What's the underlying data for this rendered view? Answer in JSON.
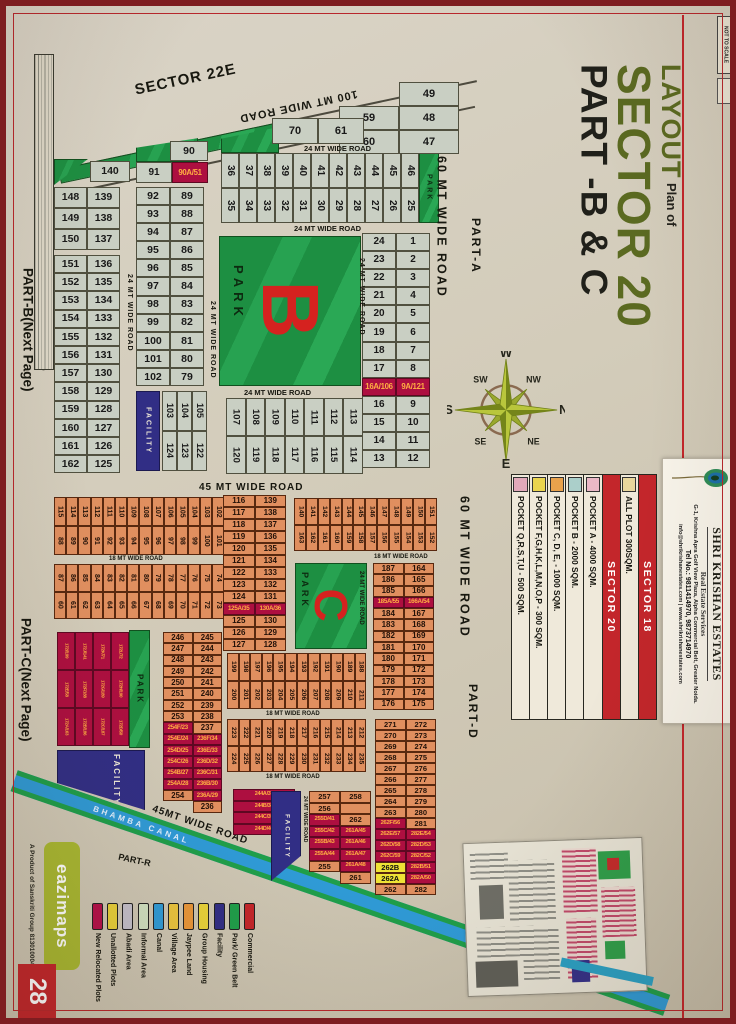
{
  "page": {
    "number": "28",
    "publisher": "eazimaps",
    "publisher_tm": "TM",
    "product": "A Product of Sanskriti Group 8130100046, 9910582177",
    "not_to_scale": "NOT TO SCALE"
  },
  "title": {
    "line1": "LAYOUT",
    "line2": "Plan of",
    "line3": "SECTOR 20",
    "line4": "PART -B & C"
  },
  "sections": {
    "sector22e": "SECTOR 22E",
    "part_a": "PART-A",
    "part_b": "PART-B(Next Page)",
    "part_c": "PART-C(Next Page)",
    "part_d": "PART-D",
    "part_r": "PART-R"
  },
  "roads": {
    "r100": "100 MT WIDE ROAD",
    "r60": "60 MT WIDE ROAD",
    "r45": "45 MT WIDE ROAD",
    "r45b": "45MT WIDE ROAD",
    "r24": "24 MT WIDE ROAD",
    "r18": "18 MT WIDE ROAD",
    "canal": "BHAMBA CANAL"
  },
  "labels": {
    "park": "PARK",
    "facility": "FACILITY",
    "park_b": "B",
    "park_c": "C"
  },
  "compass": {
    "n": "N",
    "s": "S",
    "e": "E",
    "w": "W",
    "ne": "NE",
    "nw": "NW",
    "se": "SE",
    "sw": "SW"
  },
  "info_table": {
    "rows": [
      {
        "label": "SECTOR 18",
        "cls": "hdr"
      },
      {
        "label": "ALL PLOT  300SQM.",
        "color": "#e9d79c"
      },
      {
        "label": "SECTOR 20",
        "cls": "hdr"
      },
      {
        "label": "POCKET A   -  4000 SQM.",
        "color": "#eab8c6"
      },
      {
        "label": "POCKET B   -  2000 SQM.",
        "color": "#abcfca"
      },
      {
        "label": "POCKET C, D, E, - 1000 SQM.",
        "color": "#e9a24c"
      },
      {
        "label": "POCKET  F,G,H,K,L,M,N,O,P - 300 SQM.",
        "color": "#ead44e"
      },
      {
        "label": "POCKET Q,R,S,T,U   -   500 SQM.",
        "color": "#e2a9ba"
      }
    ]
  },
  "card": {
    "name": "SHRI KRISHAN ESTATES",
    "tagline": "Real Estate Services",
    "address": "G-1, Krishna Apra Golf View Plaza, Alpha Commercial Belt, Greater Noida.",
    "phone": "Tel No.: 9811414970, 9873714970",
    "email": "info@shrikrishanestates.com | www.shrikrishanestates.com"
  },
  "legend": {
    "items": [
      {
        "label": "New Relocated Plots",
        "color": "#b5104a"
      },
      {
        "label": "Unallotted Plots",
        "color": "#e8cf3a"
      },
      {
        "label": "Abadi Area",
        "color": "#c3bfca"
      },
      {
        "label": "Informal Area",
        "color": "#cfdfc0"
      },
      {
        "label": "Canal",
        "color": "#2f9ad6"
      },
      {
        "label": "Village Area",
        "color": "#eac43e"
      },
      {
        "label": "Jaypee Land",
        "color": "#e8963a"
      },
      {
        "label": "Group Housing",
        "color": "#e8d23a"
      },
      {
        "label": "Facility",
        "color": "#312e85"
      },
      {
        "label": "Park/ Green Belt",
        "color": "#1f9e4a"
      },
      {
        "label": "Commercial",
        "color": "#c3262b"
      }
    ]
  },
  "plots": {
    "stair49": [
      [
        "",
        "49"
      ],
      [
        "59",
        "48"
      ],
      [
        "60",
        "47"
      ]
    ],
    "pair7061": [
      [
        "70",
        "61"
      ]
    ],
    "grid36": [
      [
        "36",
        "35"
      ],
      [
        "37",
        "34"
      ],
      [
        "38",
        "33"
      ],
      [
        "39",
        "32"
      ],
      [
        "40",
        "31"
      ],
      [
        "41",
        "30"
      ],
      [
        "42",
        "29"
      ],
      [
        "43",
        "28"
      ],
      [
        "44",
        "27"
      ],
      [
        "45",
        "26"
      ],
      [
        "46",
        "25"
      ]
    ],
    "cell90": "90",
    "cell140": "140",
    "pair91": [
      [
        "91",
        "90A/51"
      ]
    ],
    "colA": [
      [
        "148",
        "139"
      ],
      [
        "149",
        "138"
      ],
      [
        "150",
        "137"
      ]
    ],
    "colB": [
      [
        "151",
        "136"
      ],
      [
        "152",
        "135"
      ],
      [
        "153",
        "134"
      ],
      [
        "154",
        "133"
      ],
      [
        "155",
        "132"
      ],
      [
        "156",
        "131"
      ],
      [
        "157",
        "130"
      ],
      [
        "158",
        "129"
      ],
      [
        "159",
        "128"
      ],
      [
        "160",
        "127"
      ],
      [
        "161",
        "126"
      ],
      [
        "162",
        "125"
      ]
    ],
    "colC": [
      [
        "92",
        "89"
      ],
      [
        "93",
        "88"
      ],
      [
        "94",
        "87"
      ],
      [
        "95",
        "86"
      ],
      [
        "96",
        "85"
      ],
      [
        "97",
        "84"
      ],
      [
        "98",
        "83"
      ],
      [
        "99",
        "82"
      ],
      [
        "100",
        "81"
      ],
      [
        "101",
        "80"
      ],
      [
        "102",
        "79"
      ]
    ],
    "g103": [
      [
        "103",
        "124"
      ],
      [
        "104",
        "123"
      ],
      [
        "105",
        "122"
      ]
    ],
    "g107": [
      [
        "107",
        "120"
      ],
      [
        "108",
        "119"
      ],
      [
        "109",
        "118"
      ],
      [
        "110",
        "117"
      ],
      [
        "111",
        "116"
      ],
      [
        "112",
        "115"
      ],
      [
        "113",
        "114"
      ]
    ],
    "colR": [
      [
        "24",
        "1"
      ],
      [
        "23",
        "2"
      ],
      [
        "22",
        "3"
      ],
      [
        "21",
        "4"
      ],
      [
        "20",
        "5"
      ],
      [
        "19",
        "6"
      ],
      [
        "18",
        "7"
      ],
      [
        "17",
        "8"
      ],
      [
        "16A/106",
        "9A/121"
      ],
      [
        "16",
        "9"
      ],
      [
        "15",
        "10"
      ],
      [
        "14",
        "11"
      ],
      [
        "13",
        "12"
      ]
    ],
    "gO1": [
      [
        "115",
        "88"
      ],
      [
        "114",
        "89"
      ],
      [
        "113",
        "90"
      ],
      [
        "112",
        "91"
      ],
      [
        "111",
        "92"
      ],
      [
        "110",
        "93"
      ],
      [
        "109",
        "94"
      ],
      [
        "108",
        "95"
      ],
      [
        "107",
        "96"
      ],
      [
        "106",
        "97"
      ],
      [
        "105",
        "98"
      ],
      [
        "104",
        "99"
      ],
      [
        "103",
        "100"
      ],
      [
        "102",
        "101"
      ]
    ],
    "gO2": [
      [
        "87",
        "60"
      ],
      [
        "86",
        "61"
      ],
      [
        "85",
        "62"
      ],
      [
        "84",
        "63"
      ],
      [
        "83",
        "64"
      ],
      [
        "82",
        "65"
      ],
      [
        "81",
        "66"
      ],
      [
        "80",
        "67"
      ],
      [
        "79",
        "68"
      ],
      [
        "78",
        "69"
      ],
      [
        "77",
        "70"
      ],
      [
        "76",
        "71"
      ],
      [
        "75",
        "72"
      ],
      [
        "74",
        "73"
      ]
    ],
    "colO1": [
      [
        "116",
        "139"
      ],
      [
        "117",
        "138"
      ],
      [
        "118",
        "137"
      ],
      [
        "119",
        "136"
      ],
      [
        "120",
        "135"
      ],
      [
        "121",
        "134"
      ],
      [
        "122",
        "133"
      ],
      [
        "123",
        "132"
      ],
      [
        "124",
        "131"
      ],
      [
        "125A/35",
        "130A/36"
      ],
      [
        "125",
        "130"
      ],
      [
        "126",
        "129"
      ],
      [
        "127",
        "128"
      ]
    ],
    "gO3": [
      [
        "140",
        "163"
      ],
      [
        "141",
        "162"
      ],
      [
        "142",
        "161"
      ],
      [
        "143",
        "160"
      ],
      [
        "144",
        "159"
      ],
      [
        "145",
        "158"
      ],
      [
        "146",
        "157"
      ],
      [
        "147",
        "156"
      ],
      [
        "148",
        "155"
      ],
      [
        "149",
        "154"
      ],
      [
        "150",
        "153"
      ],
      [
        "151",
        "152"
      ]
    ],
    "colO2": [
      [
        "187",
        "164"
      ],
      [
        "186",
        "165"
      ],
      [
        "185",
        "166"
      ],
      [
        "185A/55",
        "166A/54"
      ],
      [
        "184",
        "167"
      ],
      [
        "183",
        "168"
      ],
      [
        "182",
        "169"
      ],
      [
        "181",
        "170"
      ],
      [
        "180",
        "171"
      ],
      [
        "179",
        "172"
      ],
      [
        "178",
        "173"
      ],
      [
        "177",
        "174"
      ],
      [
        "176",
        "175"
      ]
    ],
    "colO3": [
      [
        "246",
        "245"
      ],
      [
        "247",
        "244"
      ],
      [
        "248",
        "243"
      ],
      [
        "249",
        "242"
      ],
      [
        "250",
        "241"
      ],
      [
        "251",
        "240"
      ],
      [
        "252",
        "239"
      ],
      [
        "253",
        "238"
      ],
      [
        "254F/23",
        "237"
      ],
      [
        "254E/24",
        "236F/34"
      ],
      [
        "254D/25",
        "236E/33"
      ],
      [
        "254C/26",
        "236D/32"
      ],
      [
        "254B/27",
        "236C/31"
      ],
      [
        "254A/28",
        "236B/30"
      ],
      [
        "254",
        "236A/29"
      ],
      [
        "",
        "236"
      ]
    ],
    "gO4": [
      [
        "199",
        "200"
      ],
      [
        "198",
        "201"
      ],
      [
        "197",
        "202"
      ],
      [
        "196",
        "203"
      ],
      [
        "195",
        "204"
      ],
      [
        "194",
        "205"
      ],
      [
        "193",
        "206"
      ],
      [
        "192",
        "207"
      ],
      [
        "191",
        "208"
      ],
      [
        "190",
        "209"
      ],
      [
        "189",
        "210"
      ],
      [
        "188",
        "211"
      ]
    ],
    "gO5": [
      [
        "223",
        "224"
      ],
      [
        "222",
        "225"
      ],
      [
        "221",
        "226"
      ],
      [
        "220",
        "227"
      ],
      [
        "219",
        "228"
      ],
      [
        "218",
        "229"
      ],
      [
        "217",
        "230"
      ],
      [
        "216",
        "231"
      ],
      [
        "215",
        "232"
      ],
      [
        "214",
        "233"
      ],
      [
        "213",
        "234"
      ],
      [
        "212",
        "235"
      ]
    ],
    "crim172": [
      [
        "172I/199",
        "172J/141",
        "172K/71",
        "172L/72"
      ],
      [
        "172E/58",
        "172F/188",
        "172G/189",
        "172H/190"
      ],
      [
        "172A/163",
        "172B/186",
        "172C/187",
        "172D/50"
      ]
    ],
    "crim244": [
      "244A/37",
      "244B/38",
      "244C/39",
      "244D/40"
    ],
    "colBR1": [
      [
        "257",
        "258"
      ],
      [
        "256",
        "~"
      ],
      [
        "255D/41",
        "262"
      ],
      [
        "255C/42",
        "261A/45"
      ],
      [
        "255B/43",
        "261A/46"
      ],
      [
        "255A/44",
        "261A/47"
      ],
      [
        "255",
        "261A/48"
      ],
      [
        "",
        "261"
      ]
    ],
    "colBR2": [
      [
        "271",
        "272"
      ],
      [
        "270",
        "273"
      ],
      [
        "269",
        "274"
      ],
      [
        "268",
        "275"
      ],
      [
        "267",
        "276"
      ],
      [
        "266",
        "277"
      ],
      [
        "265",
        "278"
      ],
      [
        "264",
        "279"
      ],
      [
        "263",
        "280"
      ],
      [
        "262F/56",
        "281"
      ],
      [
        "262E/57",
        "282E/54"
      ],
      [
        "262D/58",
        "282D/53"
      ],
      [
        "262C/59",
        "282C/52"
      ],
      [
        "^262B",
        "282B/51"
      ],
      [
        "^262A",
        "282A/50"
      ],
      [
        "262",
        "282"
      ]
    ]
  }
}
